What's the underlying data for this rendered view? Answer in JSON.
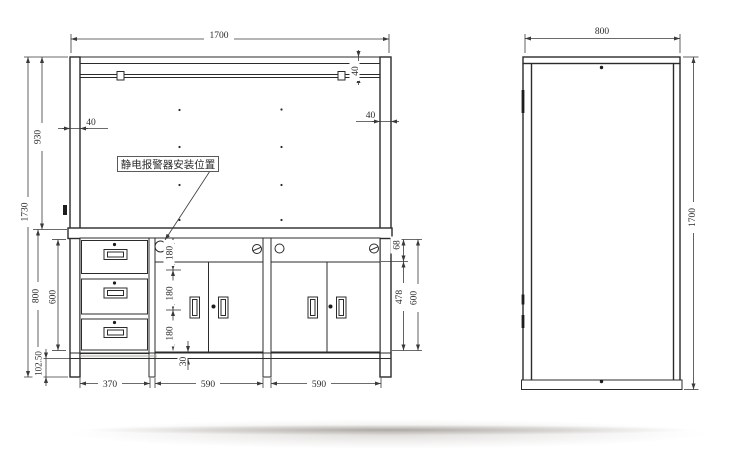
{
  "front_view": {
    "alarm_label": "静电报警器安装位置",
    "dims": {
      "overall_width": "1700",
      "overall_height": "1730",
      "upper_height": "930",
      "lower_height": "800",
      "drawer_stack_height": "600",
      "base_height": "102.50",
      "left_post_width": "40",
      "right_post_width": "40",
      "lamp_rail_offset": "40",
      "drawer_unit_width": "370",
      "left_cabinet_width": "590",
      "right_cabinet_width": "590",
      "side_hole_pitch_1": "180",
      "side_hole_pitch_2": "180",
      "side_hole_pitch_3": "180",
      "bottom_clearance": "30",
      "apron_height": "68",
      "door_height": "478",
      "cabinet_height": "600"
    }
  },
  "side_view": {
    "dims": {
      "depth": "800",
      "height": "1700"
    }
  },
  "colors": {
    "line": "#2b2b2b",
    "background": "#ffffff",
    "shadow": "#b9b4ae"
  }
}
